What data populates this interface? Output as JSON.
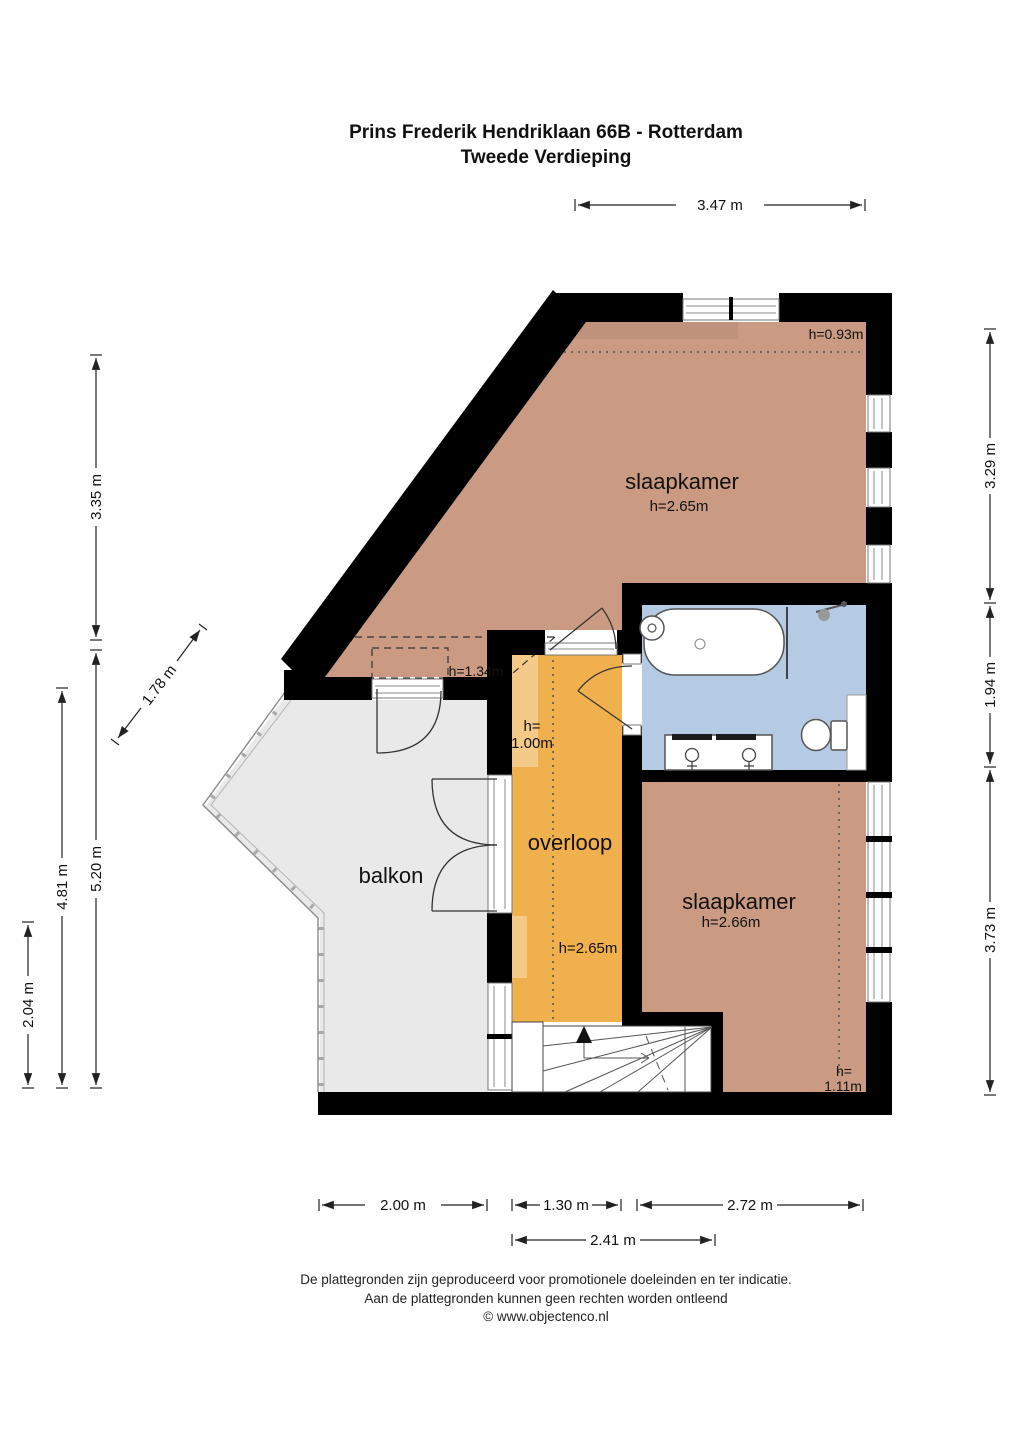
{
  "title": {
    "line1": "Prins Frederik Hendriklaan 66B - Rotterdam",
    "line2": "Tweede Verdieping"
  },
  "rooms": {
    "bedroom1": {
      "name": "slaapkamer",
      "height": "h=2.65m"
    },
    "bedroom2": {
      "name": "slaapkamer",
      "height": "h=2.66m"
    },
    "landing": {
      "name": "overloop",
      "height": "h=2.65m"
    },
    "balcony": {
      "name": "balkon"
    }
  },
  "annotations": {
    "a093": "h=0.93m",
    "a134": "h=1.34m",
    "a100_line1": "h=",
    "a100_line2": "1.00m",
    "a111_line1": "h=",
    "a111_line2": "1.11m"
  },
  "dimensions": {
    "top_347": "3.47 m",
    "left_335": "3.35 m",
    "left_520": "5.20 m",
    "left_481": "4.81 m",
    "left_204": "2.04 m",
    "diag_178": "1.78 m",
    "right_329": "3.29 m",
    "right_194": "1.94 m",
    "right_373": "3.73 m",
    "bottom_200": "2.00 m",
    "bottom_130": "1.30 m",
    "bottom_272": "2.72 m",
    "bottom_241": "2.41 m"
  },
  "footer": {
    "line1": "De plattegronden zijn geproduceerd voor promotionele doeleinden en ter indicatie.",
    "line2": "Aan de plattegronden kunnen geen rechten worden ontleend",
    "line3": "© www.objectenco.nl"
  },
  "colors": {
    "room": "#ca9b82",
    "landing": "#f0b04e",
    "bath": "#b5cbe3",
    "balcony": "#e9e9e9",
    "wall": "#000000"
  }
}
